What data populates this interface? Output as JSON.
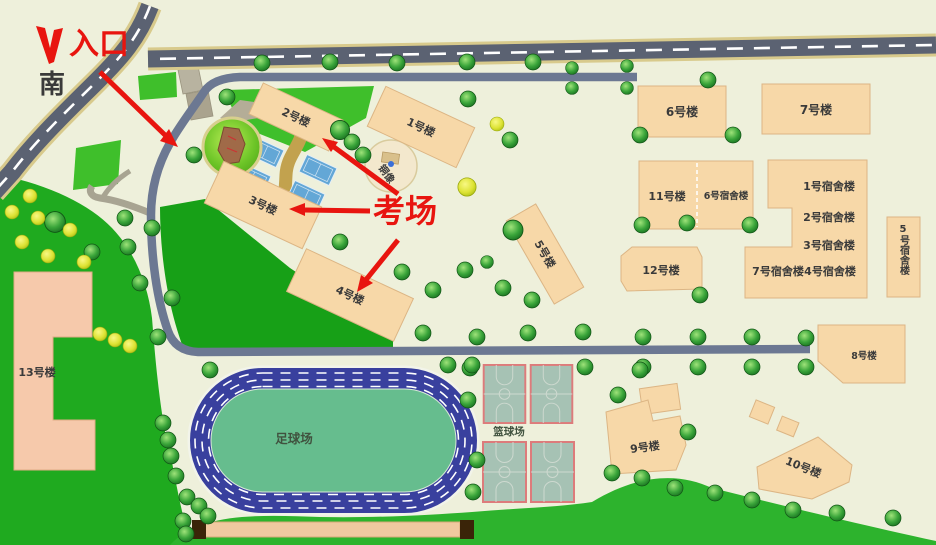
{
  "annotations": {
    "entrance": "入口",
    "south": "南",
    "exam_site": "考场"
  },
  "buildings": {
    "b1": "1号楼",
    "b2": "2号楼",
    "b3": "3号楼",
    "b4": "4号楼",
    "b5": "5号楼",
    "b6": "6号楼",
    "b7": "7号楼",
    "b8": "8号楼",
    "b9": "9号楼",
    "b10": "10号楼",
    "b11": "11号楼",
    "b12": "12号楼",
    "b13": "13号楼"
  },
  "dorms": {
    "d1": "1号宿舍楼",
    "d2": "2号宿舍楼",
    "d3": "3号宿舍楼",
    "d4": "4号宿舍楼",
    "d5": "5号宿舍楼",
    "d6": "6号宿舍楼",
    "d7": "7号宿舍楼"
  },
  "facilities": {
    "football_field": "足球场",
    "basketball_court": "篮球场",
    "bronze_statue": "铜像"
  },
  "colors": {
    "annotation_red": "#e8150f",
    "building_fill": "#f7d8a8",
    "building13_fill": "#f6c9ab",
    "main_road": "#5b6272",
    "road_edge": "#d8ca8c",
    "campus_road": "#6c7892",
    "track_blue": "#39409e",
    "field_green": "#66bd8e",
    "lawn_green": "#1faa1f",
    "court_blue": "#63a7d6",
    "court_gray_green": "#a6c2b4",
    "court_border_red": "#dd7b7b",
    "path_tan": "#c2a24e",
    "background": "#eef0db"
  }
}
